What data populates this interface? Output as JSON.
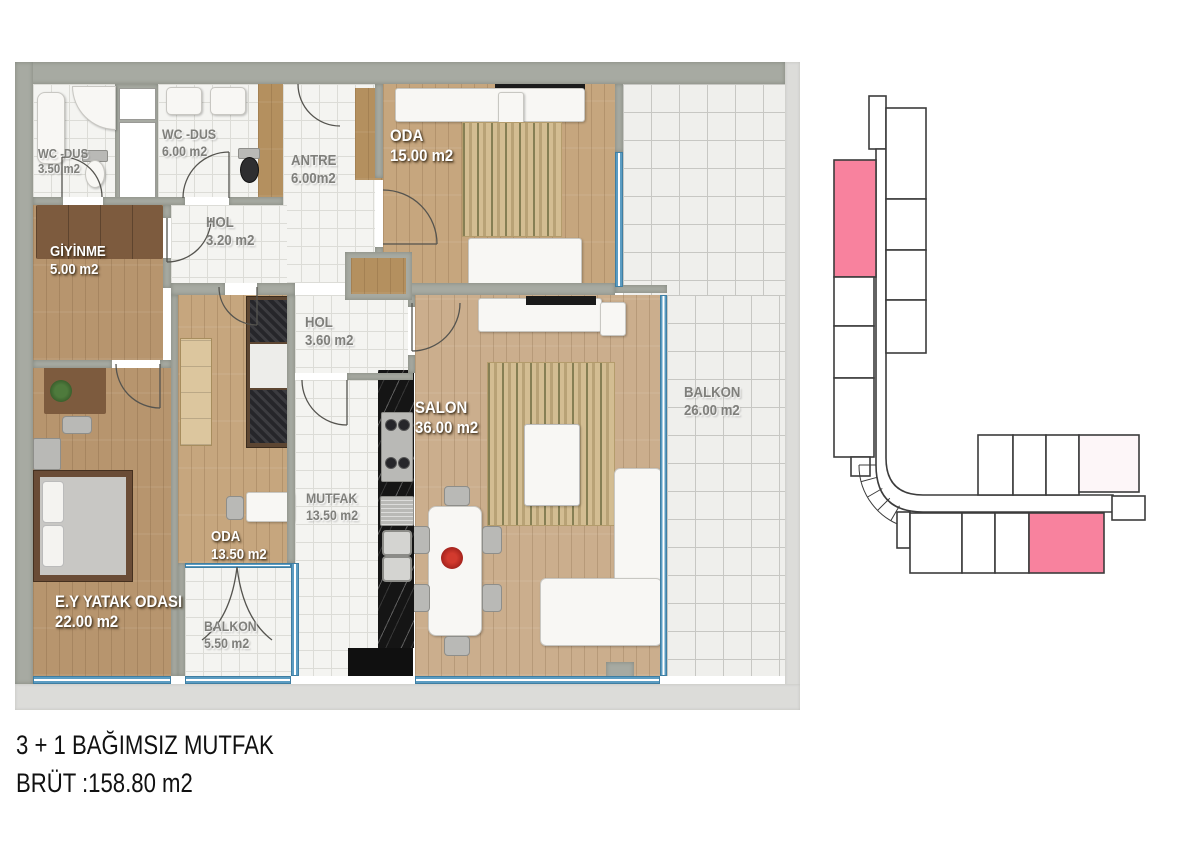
{
  "rooms": {
    "wc1": {
      "name": "WC -DUS",
      "area": "3.50 m2"
    },
    "wc2": {
      "name": "WC -DUS",
      "area": "6.00 m2"
    },
    "antre": {
      "name": "ANTRE",
      "area": "6.00m2"
    },
    "hol1": {
      "name": "HOL",
      "area": "3.20 m2"
    },
    "oda1": {
      "name": "ODA",
      "area": "15.00 m2"
    },
    "giyinme": {
      "name": "GİYİNME",
      "area": "5.00 m2"
    },
    "hol2": {
      "name": "HOL",
      "area": "3.60 m2"
    },
    "salon": {
      "name": "SALON",
      "area": "36.00 m2"
    },
    "balkon1": {
      "name": "BALKON",
      "area": "26.00 m2"
    },
    "mutfak": {
      "name": "MUTFAK",
      "area": "13.50 m2"
    },
    "oda2": {
      "name": "ODA",
      "area": "13.50 m2"
    },
    "master": {
      "name": "E.Y YATAK ODASI",
      "area": "22.00 m2"
    },
    "balkon2": {
      "name": "BALKON",
      "area": "5.50 m2"
    }
  },
  "footer": {
    "type_label": "3 + 1 BAĞIMSIZ MUTFAK",
    "gross_area_label": "BRÜT :158.80 m2"
  },
  "diagram": {
    "highlight_color": "#f8829e",
    "highlight_light": "#fdf6f8",
    "outline_color": "#3c3c3c",
    "unit_fill": "#ffffff"
  }
}
